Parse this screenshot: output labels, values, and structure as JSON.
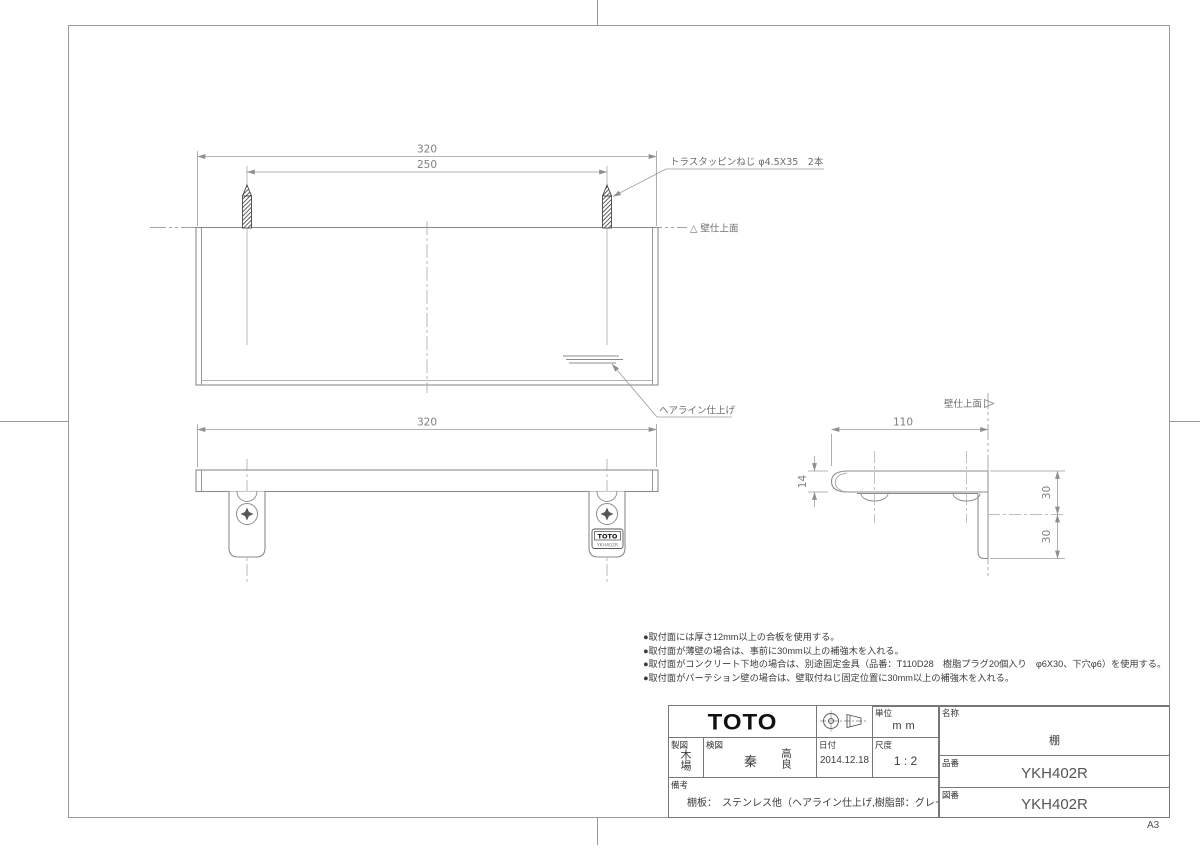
{
  "sheet": {
    "size": "A3"
  },
  "top_view": {
    "dim_width": "320",
    "dim_pitch": "250",
    "screw_note": "トラスタッピンねじ φ4.5X35　2本",
    "wall_label": "△ 壁仕上面",
    "hairline_label": "ヘアライン仕上げ"
  },
  "front_view": {
    "dim_width": "320"
  },
  "side_view": {
    "dim_depth": "110",
    "dim_thickness": "14",
    "dim_upper": "30",
    "dim_lower": "30",
    "wall_label": "壁仕上面"
  },
  "bracket_tag": {
    "brand": "TOTO",
    "model": "YKH402R"
  },
  "notes": [
    "●取付面には厚さ12mm以上の合板を使用する。",
    "●取付面が薄壁の場合は、事前に30mm以上の補強木を入れる。",
    "●取付面がコンクリート下地の場合は、別途固定金具（品番：T110D28　樹脂プラグ20個入り　φ6X30、下穴φ6）を使用する。",
    "●取付面がパーテション壁の場合は、壁取付ねじ固定位置に30mm以上の補強木を入れる。"
  ],
  "title_block": {
    "brand": "TOTO",
    "unit": {
      "label": "単位",
      "value": "mm"
    },
    "drafter": {
      "label": "製図",
      "value": "木場"
    },
    "checker": {
      "label": "検図",
      "stamp1": "秦",
      "stamp2": "高良"
    },
    "date": {
      "label": "日付",
      "value": "2014.12.18"
    },
    "scale": {
      "label": "尺度",
      "value": "1 : 2"
    },
    "remarks": {
      "label": "備考",
      "value": "棚板：　ステンレス他（ヘアライン仕上げ,樹脂部：グレー）"
    },
    "name": {
      "label": "名称",
      "value": "棚"
    },
    "part_no": {
      "label": "品番",
      "value": "YKH402R"
    },
    "dwg_no": {
      "label": "図番",
      "value": "YKH402R"
    }
  },
  "colors": {
    "line": "#8c8c8c",
    "dim": "#9b9b9b",
    "accent": "#111111"
  }
}
